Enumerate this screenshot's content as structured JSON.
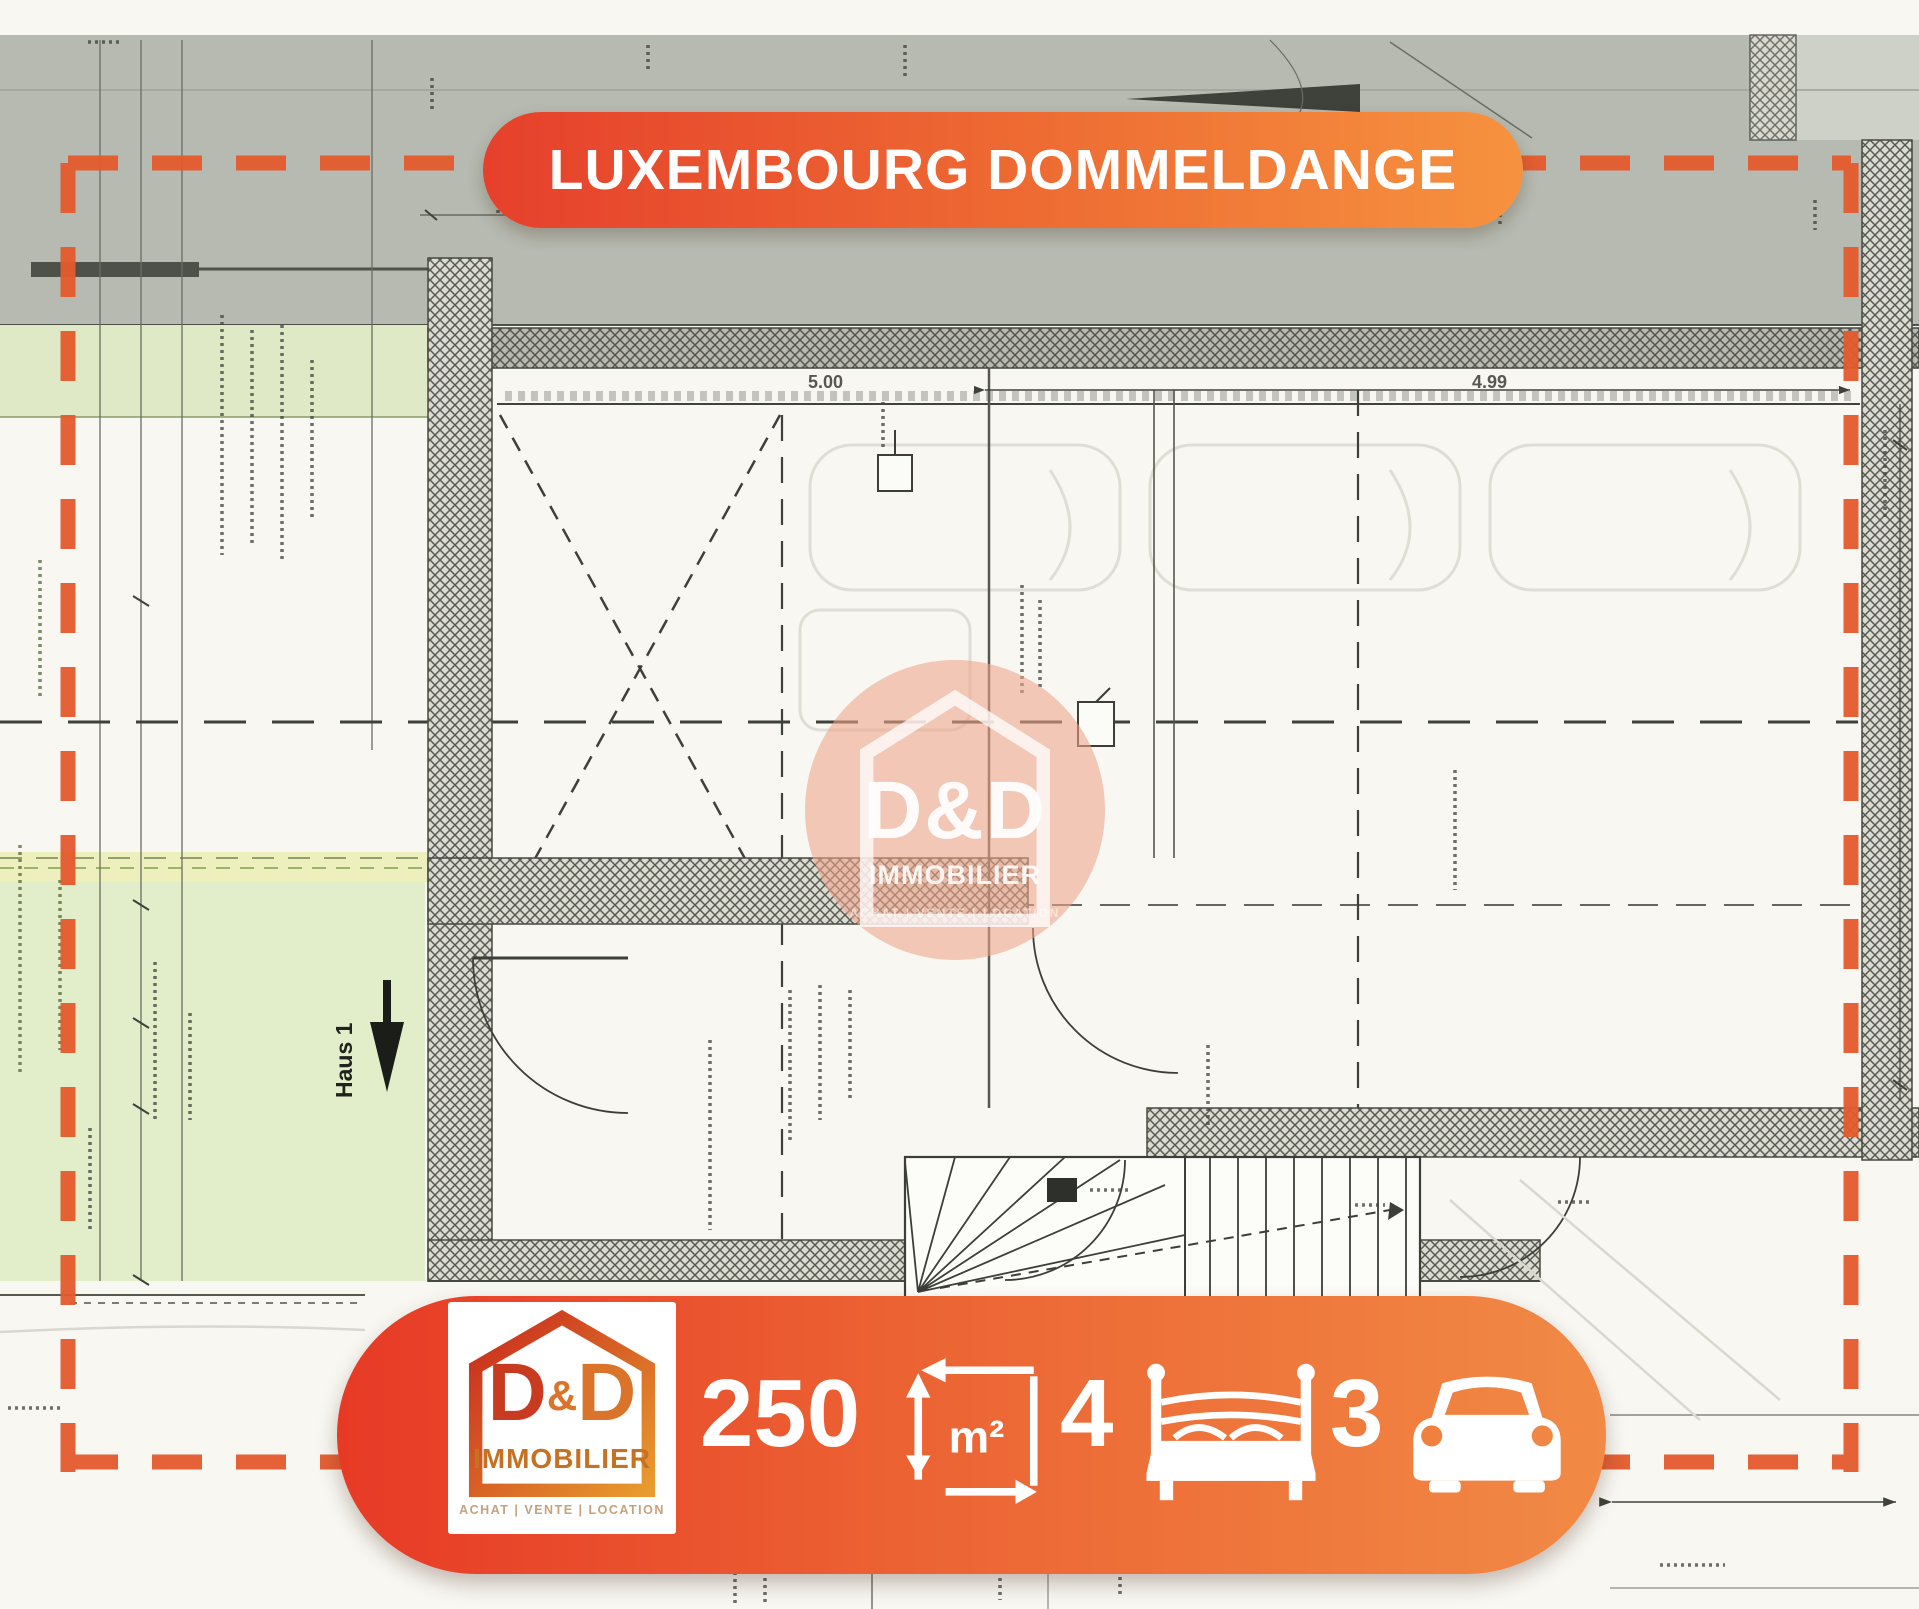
{
  "banner": {
    "title": "LUXEMBOURG DOMMELDANGE"
  },
  "agency": {
    "brand_d1": "D",
    "brand_amp": "&",
    "brand_d2": "D",
    "name": "IMMOBILIER",
    "tagline": "ACHAT  |  VENTE  |  LOCATION"
  },
  "watermark": {
    "brand": "D&D",
    "name": "IMMOBILIER",
    "tagline": "ACHAT | VENTE | LOCATION"
  },
  "stats": {
    "area": "250",
    "area_unit": "m²",
    "bedrooms": "4",
    "parking": "3"
  },
  "plan": {
    "haus_label": "Haus 1",
    "dim_left": "5.00",
    "dim_right": "4.99"
  },
  "colors": {
    "accent_red": "#e6402c",
    "accent_orange": "#f6923f",
    "boundary_dash": "#e55a2d",
    "watermark_fill": "#f0a488",
    "plan_green": "#e2edca",
    "plan_gray": "#b6bab0"
  }
}
